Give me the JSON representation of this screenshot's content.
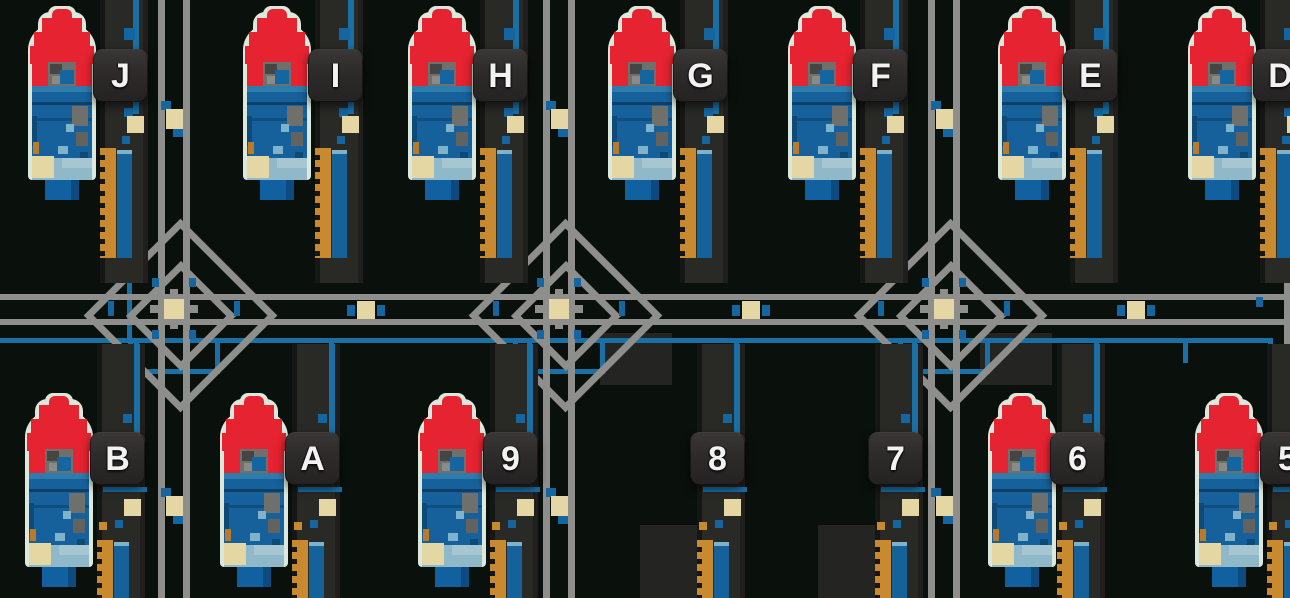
{
  "scene": {
    "title": "launch-pad-grid-map",
    "width": 1290,
    "height": 598,
    "background": "#0a100b"
  },
  "colors": {
    "background": "#0a100b",
    "road_gray": "#8e8e8c",
    "pipe_blue": "#1a6fa5",
    "accent_blue": "#1565a0",
    "beige": "#e5d7a3",
    "tower_dark": "#292926",
    "tower_shadow": "#161614",
    "pad_dark": "#242422",
    "rocket_red": "#e62330",
    "rocket_body_blue": "#16619b",
    "rocket_body_dark": "#0c4066",
    "rocket_body_light": "#2e7cab",
    "pale_outline": "#dce8dc",
    "light_band": "#8fb8c9",
    "light_band_hi": "#a6c6d2",
    "engine_blue": "#1160a0",
    "engine_shadow": "#0c4a80",
    "orange": "#c8892f",
    "gray_detail": "#6f706c",
    "badge_text": "#f2f2f2"
  },
  "rows": {
    "top": {
      "badge_y": 49,
      "rocket_y": 6,
      "tower_y": 0,
      "tower_h": 283
    },
    "bottom": {
      "badge_y": 432,
      "rocket_y": 393,
      "tower_y": 344,
      "tower_h": 254
    }
  },
  "pads": [
    {
      "label": "J",
      "row": "top",
      "rocket_x": 28,
      "tower_x": 100,
      "has_rocket": true
    },
    {
      "label": "I",
      "row": "top",
      "rocket_x": 243,
      "tower_x": 315,
      "has_rocket": true
    },
    {
      "label": "H",
      "row": "top",
      "rocket_x": 408,
      "tower_x": 480,
      "has_rocket": true
    },
    {
      "label": "G",
      "row": "top",
      "rocket_x": 608,
      "tower_x": 680,
      "has_rocket": true
    },
    {
      "label": "F",
      "row": "top",
      "rocket_x": 788,
      "tower_x": 860,
      "has_rocket": true
    },
    {
      "label": "E",
      "row": "top",
      "rocket_x": 998,
      "tower_x": 1070,
      "has_rocket": true
    },
    {
      "label": "D",
      "row": "top",
      "rocket_x": 1188,
      "tower_x": 1260,
      "has_rocket": true
    },
    {
      "label": "B",
      "row": "bottom",
      "rocket_x": 25,
      "tower_x": 97,
      "has_rocket": true
    },
    {
      "label": "A",
      "row": "bottom",
      "rocket_x": 220,
      "tower_x": 292,
      "has_rocket": true
    },
    {
      "label": "9",
      "row": "bottom",
      "rocket_x": 418,
      "tower_x": 490,
      "has_rocket": true
    },
    {
      "label": "8",
      "row": "bottom",
      "rocket_x": 645,
      "tower_x": 697,
      "has_rocket": false
    },
    {
      "label": "7",
      "row": "bottom",
      "rocket_x": 823,
      "tower_x": 875,
      "has_rocket": false
    },
    {
      "label": "6",
      "row": "bottom",
      "rocket_x": 988,
      "tower_x": 1057,
      "has_rocket": true
    },
    {
      "label": "5",
      "row": "bottom",
      "rocket_x": 1195,
      "tower_x": 1267,
      "has_rocket": true
    }
  ],
  "roads": {
    "horizontal_lines_y": [
      294,
      319
    ],
    "horizontal_line_h": 6,
    "vertical_centers_x": [
      174,
      559,
      944
    ],
    "vertical_line_w": 7,
    "edge_vertical": {
      "x": 1284,
      "y": 276,
      "w": 6,
      "h": 322
    }
  },
  "intersections": [
    {
      "x": 174,
      "y": 309
    },
    {
      "x": 559,
      "y": 309
    },
    {
      "x": 944,
      "y": 309
    }
  ],
  "pad_shadows": [
    {
      "x": 600,
      "y": 333,
      "w": 72,
      "h": 52
    },
    {
      "x": 980,
      "y": 333,
      "w": 72,
      "h": 52
    }
  ],
  "markers": {
    "vertical_road_crates_y": [
      109,
      496
    ],
    "mid_road_crates_x": [
      357,
      742,
      1127
    ],
    "mid_road_crates_y": 301,
    "edge_tab": {
      "x": 1256,
      "y": 297,
      "w": 7,
      "h": 10
    }
  },
  "pipes": [
    {
      "x": 0,
      "y": 338,
      "w": 1268,
      "h": 5
    },
    {
      "x": 1268,
      "y": 338,
      "w": 5,
      "h": 46
    },
    {
      "x": 1268,
      "y": 379,
      "w": 22,
      "h": 5
    },
    {
      "x": 128,
      "y": 341,
      "w": 5,
      "h": 33
    },
    {
      "x": 128,
      "y": 369,
      "w": 92,
      "h": 5
    },
    {
      "x": 215,
      "y": 341,
      "w": 5,
      "h": 33
    },
    {
      "x": 513,
      "y": 341,
      "w": 5,
      "h": 33
    },
    {
      "x": 513,
      "y": 369,
      "w": 92,
      "h": 5
    },
    {
      "x": 600,
      "y": 341,
      "w": 5,
      "h": 33
    },
    {
      "x": 898,
      "y": 341,
      "w": 5,
      "h": 33
    },
    {
      "x": 898,
      "y": 369,
      "w": 92,
      "h": 5
    },
    {
      "x": 985,
      "y": 341,
      "w": 5,
      "h": 33
    },
    {
      "x": 134,
      "y": 341,
      "w": 5,
      "h": 92
    },
    {
      "x": 329,
      "y": 341,
      "w": 5,
      "h": 92
    },
    {
      "x": 527,
      "y": 341,
      "w": 5,
      "h": 92
    },
    {
      "x": 734,
      "y": 341,
      "w": 5,
      "h": 92
    },
    {
      "x": 912,
      "y": 341,
      "w": 5,
      "h": 92
    },
    {
      "x": 1094,
      "y": 341,
      "w": 5,
      "h": 92
    },
    {
      "x": 127,
      "y": 226,
      "w": 5,
      "h": 112
    },
    {
      "x": 1183,
      "y": 341,
      "w": 5,
      "h": 22
    }
  ]
}
